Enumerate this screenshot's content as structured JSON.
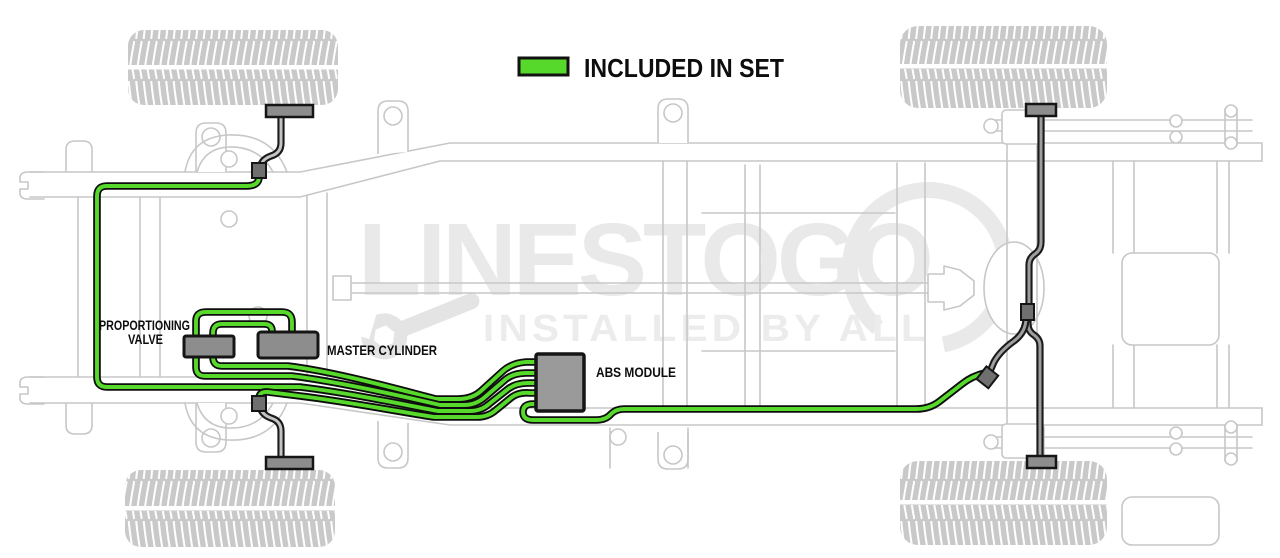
{
  "legend": {
    "label": "INCLUDED IN SET",
    "swatch_color": "#57d92b"
  },
  "labels": {
    "proportioning_valve_line1": "PROPORTIONING",
    "proportioning_valve_line2": "VALVE",
    "master_cylinder": "MASTER CYLINDER",
    "abs_module": "ABS MODULE"
  },
  "watermark": {
    "brand": "LINESTOGO",
    "tagline": "INSTALLED BY ALL"
  },
  "components": {
    "proportioning_valve": "Proportioning Valve",
    "master_cylinder": "Master Cylinder",
    "abs_module": "ABS Module"
  },
  "colors": {
    "included_line_green": "#57d92b",
    "line_casing_black": "#0d0d0d",
    "component_gray": "#8d8d8d",
    "hose_core_gray": "#c4c4c4",
    "chassis_outline_gray": "#c7c7c7",
    "watermark_gray": "#e9e9e9",
    "label_black": "#0d0d0d",
    "tire_gray": "#c9c9c9"
  }
}
